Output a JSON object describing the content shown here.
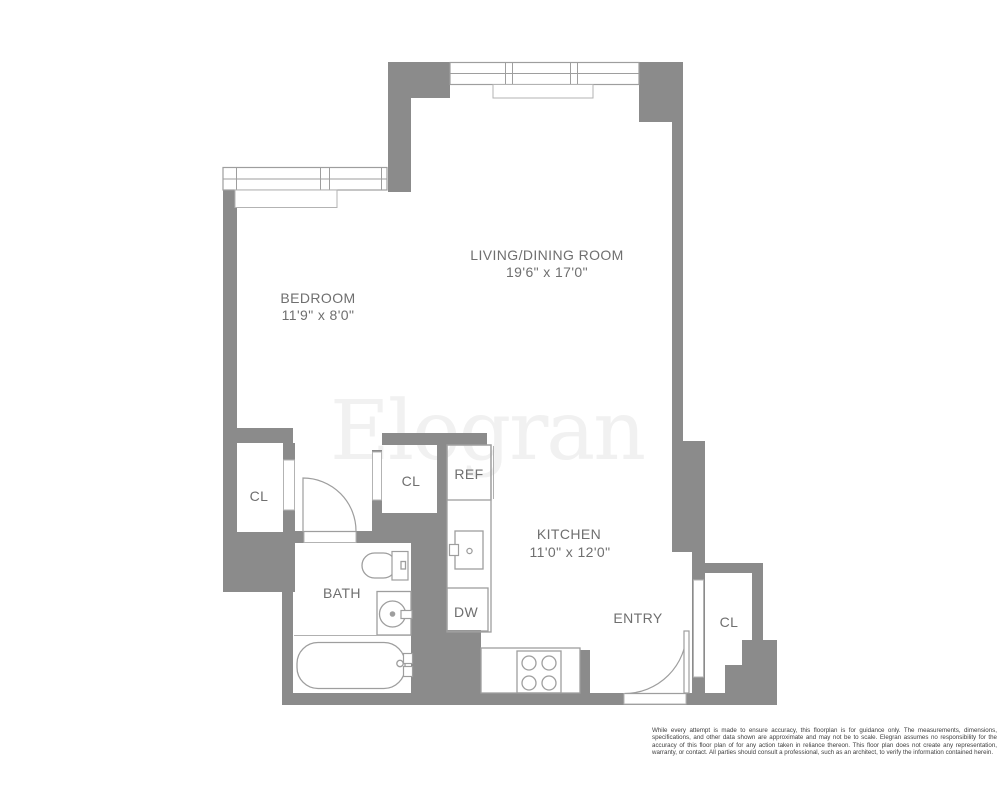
{
  "floorplan": {
    "brand_watermark": "Elegran",
    "rooms": {
      "living_dining": {
        "label": "LIVING/DINING ROOM",
        "dimensions": "19'6\" x 17'0\""
      },
      "bedroom": {
        "label": "BEDROOM",
        "dimensions": "11'9\" x 8'0\""
      },
      "kitchen": {
        "label": "KITCHEN",
        "dimensions": "11'0\" x 12'0\""
      },
      "bath": {
        "label": "BATH"
      },
      "entry": {
        "label": "ENTRY"
      }
    },
    "closets": {
      "bedroom_closet": {
        "label": "CL"
      },
      "hall_closet": {
        "label": "CL"
      },
      "entry_closet": {
        "label": "CL"
      }
    },
    "appliances": {
      "refrigerator": {
        "label": "REF"
      },
      "dishwasher": {
        "label": "DW"
      }
    },
    "colors": {
      "wall": "#8b8b8b",
      "label_text": "#6f6f6f",
      "fixture_stroke": "#9e9e9e",
      "watermark": "#f1f1f1",
      "disclaimer_text": "#3e3e3e",
      "background": "#ffffff"
    },
    "disclaimer": "While every attempt is made to ensure accuracy, this floorplan is for guidance only. The measurements, dimensions, specifications, and other data shown are approximate and may not be to scale. Elegran assumes no responsibility for the accuracy of this floor plan of for any action taken in reliance thereon. This floor plan does not create any representation, warranty, or contact. All parties should consult a professional, such as an architect, to verify the information contained herein."
  }
}
